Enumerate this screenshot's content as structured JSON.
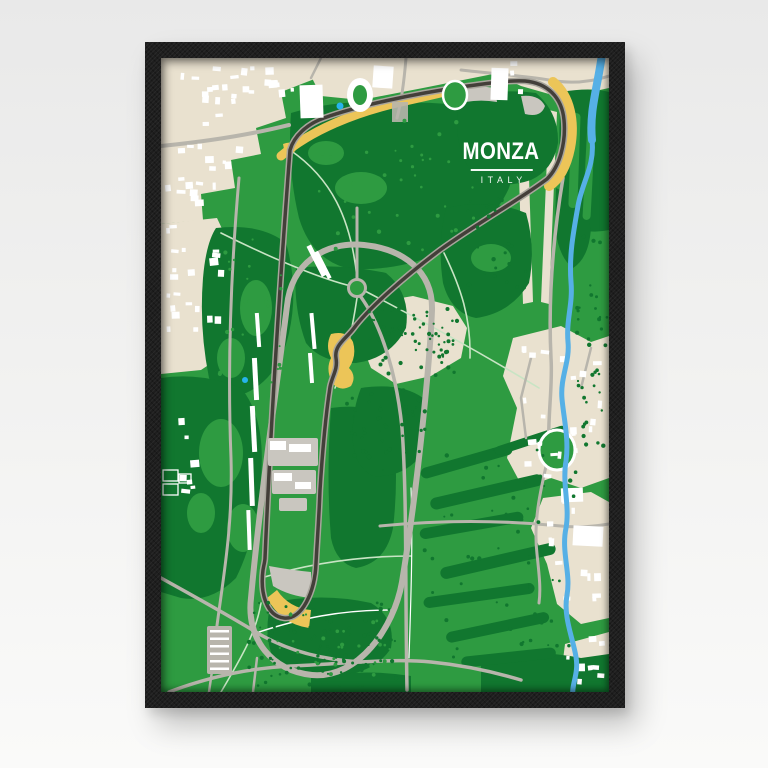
{
  "poster": {
    "title": "MONZA",
    "subtitle": "ITALY"
  },
  "colors": {
    "wall_top": "#e9e9e9",
    "wall_bottom": "#fafaf9",
    "frame": "#1e1e1e",
    "map_green": "#2e9b41",
    "map_dark_green": "#11772f",
    "map_beige": "#e9e1cf",
    "map_building": "#ffffff",
    "map_road": "#b8b5ac",
    "map_gravel": "#c9c6bf",
    "map_track": "#433f39",
    "map_track_edge": "#a8a59c",
    "map_runoff_yellow": "#ecc558",
    "map_river": "#56b0e6",
    "map_pond": "#27b4ec",
    "map_trail": "#c8e4c4",
    "title_color": "#ffffff"
  }
}
